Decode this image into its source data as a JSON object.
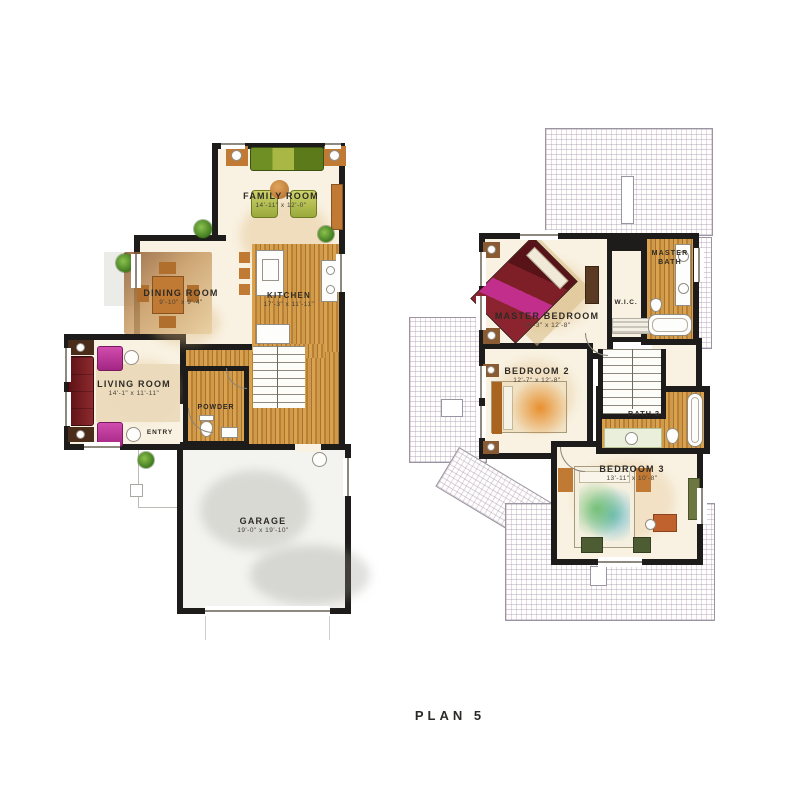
{
  "plan": {
    "title": "PLAN 5"
  },
  "floor1": {
    "family_room": {
      "name": "FAMILY ROOM",
      "dims": "14'-11\" x 12'-0\""
    },
    "dining_room": {
      "name": "DINING ROOM",
      "dims": "9'-10\" x 9'-4\""
    },
    "kitchen": {
      "name": "KITCHEN",
      "dims": "17'-3\" x 11'-11\""
    },
    "living_room": {
      "name": "LIVING ROOM",
      "dims": "14'-1\" x 11'-11\""
    },
    "powder": {
      "name": "POWDER"
    },
    "entry": {
      "name": "ENTRY"
    },
    "garage": {
      "name": "GARAGE",
      "dims": "19'-0\" x 19'-10\""
    }
  },
  "floor2": {
    "master_bedroom": {
      "name": "MASTER BEDROOM",
      "dims": "14'-3\" x 12'-8\""
    },
    "master_bath": {
      "name": "MASTER BATH"
    },
    "wic": {
      "name": "W.I.C."
    },
    "bedroom2": {
      "name": "BEDROOM 2",
      "dims": "12'-7\" x 12'-8\""
    },
    "bath2": {
      "name": "BATH 2"
    },
    "bedroom3": {
      "name": "BEDROOM 3",
      "dims": "13'-11\" x 10'-8\""
    }
  },
  "colors": {
    "wall": "#1d1c1a",
    "wood": "#c8913f",
    "roof_line": "#9a95a0",
    "accent_magenta": "#c2379f",
    "accent_orange": "#c07a34"
  }
}
